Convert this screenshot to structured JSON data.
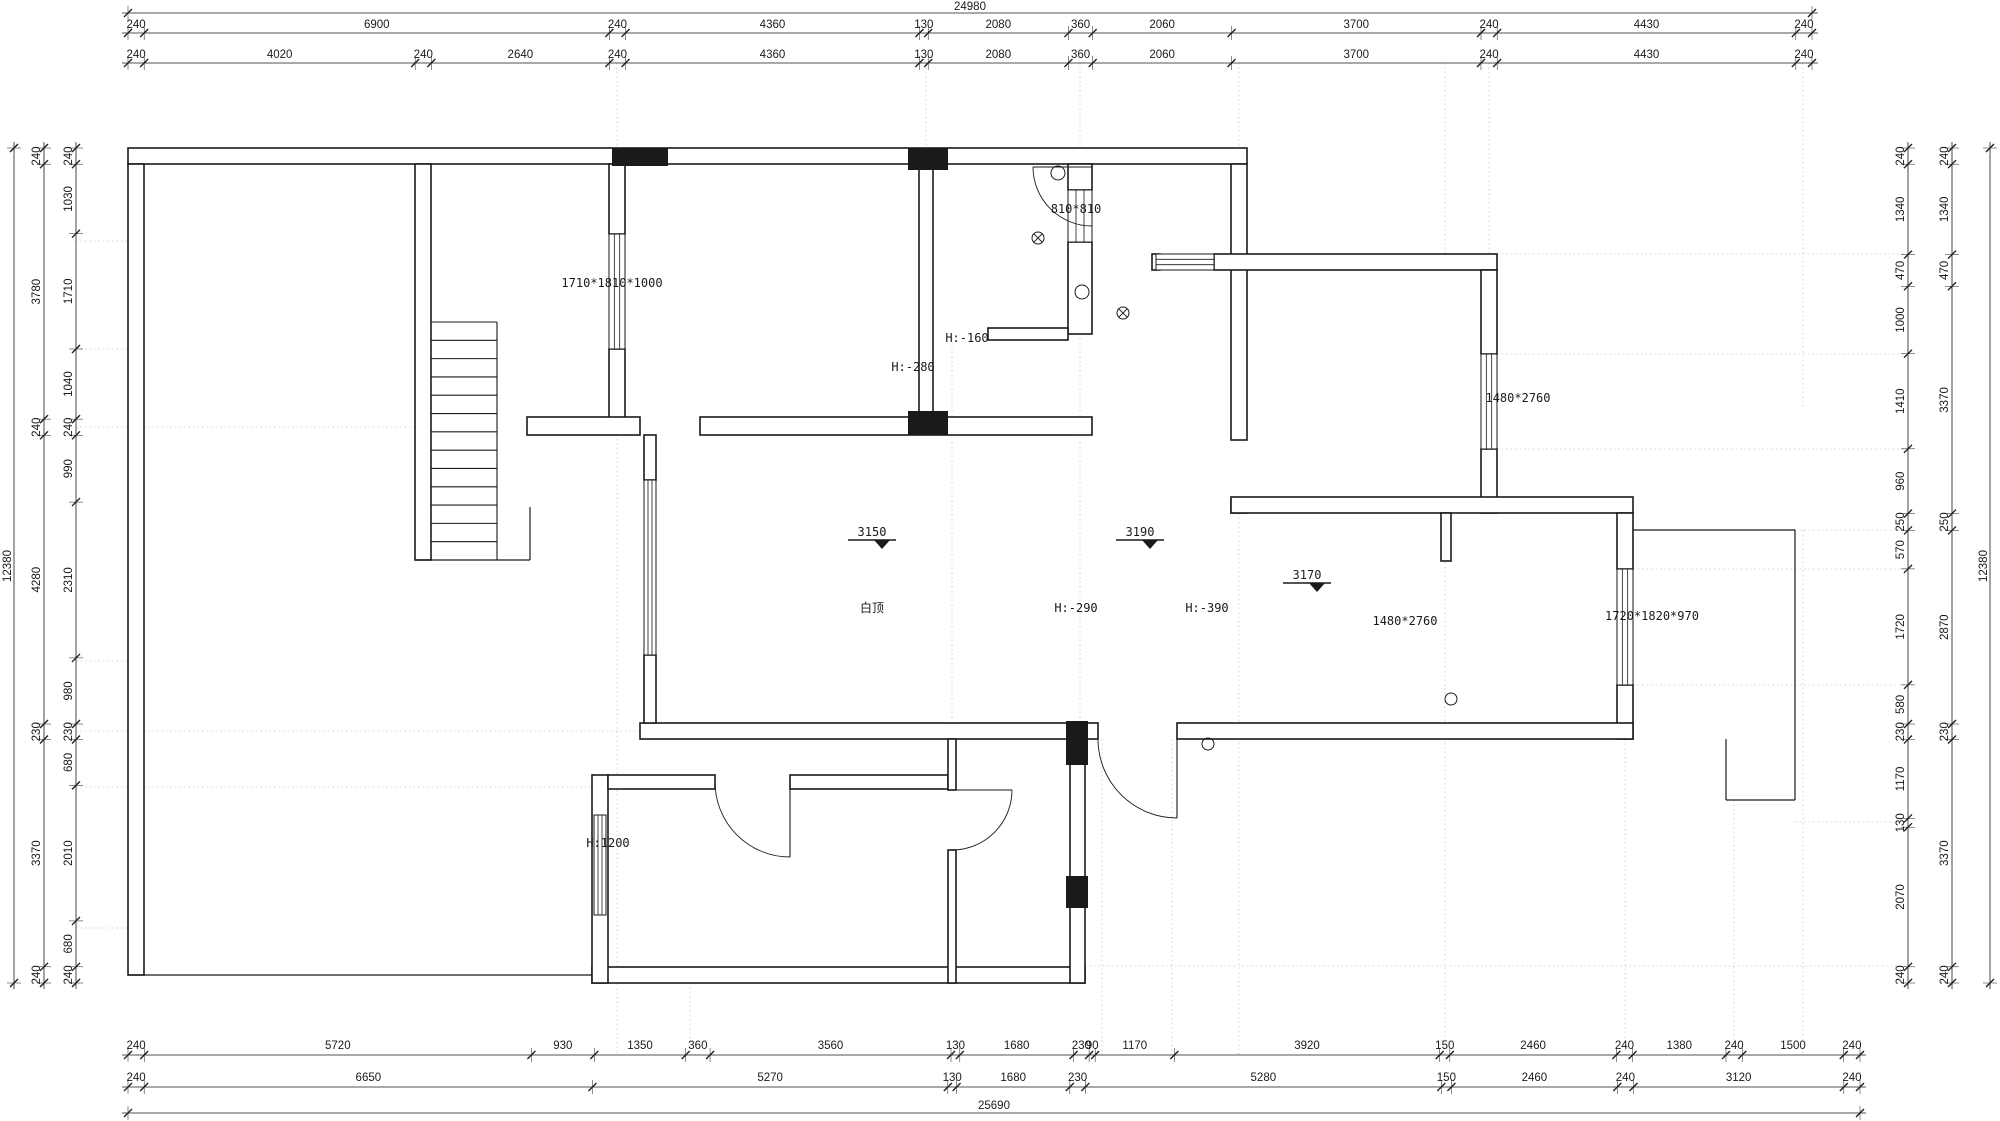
{
  "meta": {
    "drawing_type": "floor-plan",
    "line_color": "#1a1a1a",
    "guide_color": "#c9c9c9",
    "bg_color": "#ffffff"
  },
  "totals": {
    "top": "24980",
    "bottom": "25690",
    "left": "12380",
    "right": "12380"
  },
  "chains": {
    "top_row1": [
      "240",
      "6900",
      "240",
      "4360",
      "130",
      "2080",
      "360",
      "2060",
      "3700",
      "240",
      "4430",
      "240"
    ],
    "top_row2": [
      "240",
      "4020",
      "240",
      "2640",
      "240",
      "4360",
      "130",
      "2080",
      "360",
      "2060",
      "3700",
      "240",
      "4430",
      "240"
    ],
    "bottom_row1": [
      "240",
      "5720",
      "930",
      "1350",
      "360",
      "3560",
      "130",
      "1680",
      "230",
      "90",
      "1170",
      "3920",
      "150",
      "2460",
      "240",
      "1380",
      "240",
      "1500",
      "240"
    ],
    "bottom_row2": [
      "240",
      "6650",
      "5270",
      "130",
      "1680",
      "230",
      "5280",
      "150",
      "2460",
      "240",
      "3120",
      "240"
    ],
    "left_outer": [
      "240",
      "3780",
      "240",
      "4280",
      "230",
      "3370",
      "240"
    ],
    "left_inner": [
      "240",
      "1030",
      "1710",
      "1040",
      "240",
      "990",
      "2310",
      "980",
      "230",
      "680",
      "2010",
      "680",
      "240"
    ],
    "right_inner": [
      "240",
      "1340",
      "470",
      "1000",
      "1410",
      "960",
      "250",
      "570",
      "1720",
      "580",
      "230",
      "1170",
      "130",
      "2070",
      "240"
    ],
    "right_outer": [
      "240",
      "1340",
      "470",
      "3370",
      "250",
      "2870",
      "230",
      "3370",
      "240"
    ]
  },
  "annotations": [
    {
      "text": "1710*1810*1000",
      "x": 612,
      "y": 287
    },
    {
      "text": "810*810",
      "x": 1076,
      "y": 213
    },
    {
      "text": "H:-160",
      "x": 967,
      "y": 342
    },
    {
      "text": "H:-280",
      "x": 913,
      "y": 371
    },
    {
      "text": "1480*2760",
      "x": 1518,
      "y": 402
    },
    {
      "text": "白顶",
      "x": 872,
      "y": 612
    },
    {
      "text": "H:-290",
      "x": 1076,
      "y": 612
    },
    {
      "text": "H:-390",
      "x": 1207,
      "y": 612
    },
    {
      "text": "1480*2760",
      "x": 1405,
      "y": 625
    },
    {
      "text": "1720*1820*970",
      "x": 1652,
      "y": 620
    },
    {
      "text": "H:1200",
      "x": 608,
      "y": 847
    }
  ],
  "levels": [
    {
      "text": "3150",
      "x": 872,
      "y": 536
    },
    {
      "text": "3190",
      "x": 1140,
      "y": 536
    },
    {
      "text": "3170",
      "x": 1307,
      "y": 579
    }
  ]
}
